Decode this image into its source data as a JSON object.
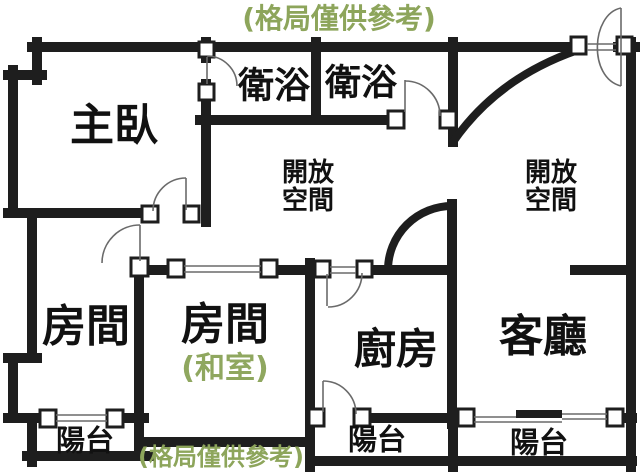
{
  "plan": {
    "notes": {
      "top": "(格局僅供參考)",
      "bottom": "(格局僅供參考)"
    },
    "rooms": {
      "master_bedroom": "主臥",
      "bathroom_1": "衛浴",
      "bathroom_2": "衛浴",
      "open_space_1": "開放\n空間",
      "open_space_2": "開放\n空間",
      "room_1": "房間",
      "room_2": "房間",
      "room_2_sub": "(和室)",
      "kitchen": "廚房",
      "living_room": "客廳",
      "balcony_1": "陽台",
      "balcony_2": "陽台",
      "balcony_3": "陽台"
    },
    "colors": {
      "wall": "#1e1e1e",
      "label": "#111111",
      "note_green": "#8da55b",
      "sub_green": "#8fa75f",
      "thin": "#6a6a6a",
      "bg": "#ffffff"
    }
  }
}
